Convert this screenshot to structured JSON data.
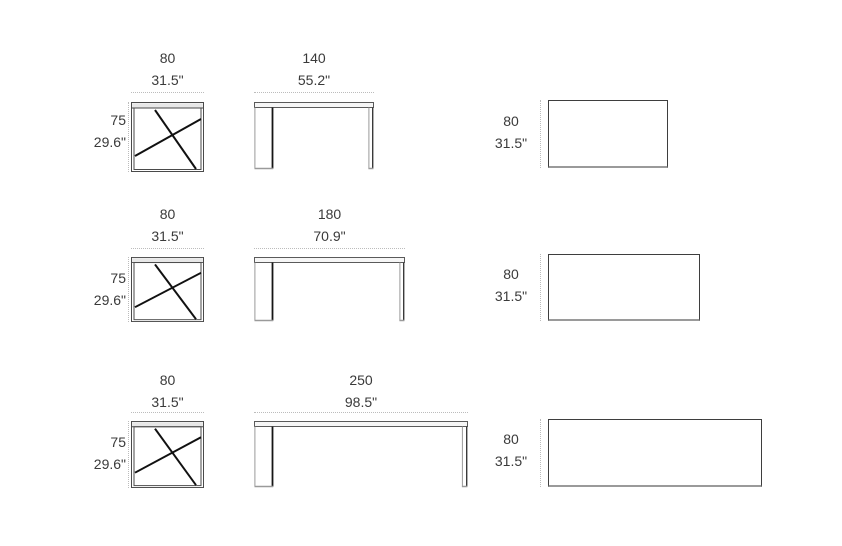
{
  "sheet": {
    "background": "#ffffff",
    "text_color": "#3a3a3a",
    "outline_color": "#4a4a4a",
    "cross_leg_color": "#111111",
    "dimension_line_color": "#bcbcbc"
  },
  "rows": [
    {
      "side_view": {
        "width_cm": "80",
        "width_in": "31.5\"",
        "height_cm": "75",
        "height_in": "29.6\""
      },
      "front_view": {
        "length_cm": "140",
        "length_in": "55.2\""
      },
      "top_view": {
        "depth_cm": "80",
        "depth_in": "31.5\""
      }
    },
    {
      "side_view": {
        "width_cm": "80",
        "width_in": "31.5\"",
        "height_cm": "75",
        "height_in": "29.6\""
      },
      "front_view": {
        "length_cm": "180",
        "length_in": "70.9\""
      },
      "top_view": {
        "depth_cm": "80",
        "depth_in": "31.5\""
      }
    },
    {
      "side_view": {
        "width_cm": "80",
        "width_in": "31.5\"",
        "height_cm": "75",
        "height_in": "29.6\""
      },
      "front_view": {
        "length_cm": "250",
        "length_in": "98.5\""
      },
      "top_view": {
        "depth_cm": "80",
        "depth_in": "31.5\""
      }
    }
  ]
}
